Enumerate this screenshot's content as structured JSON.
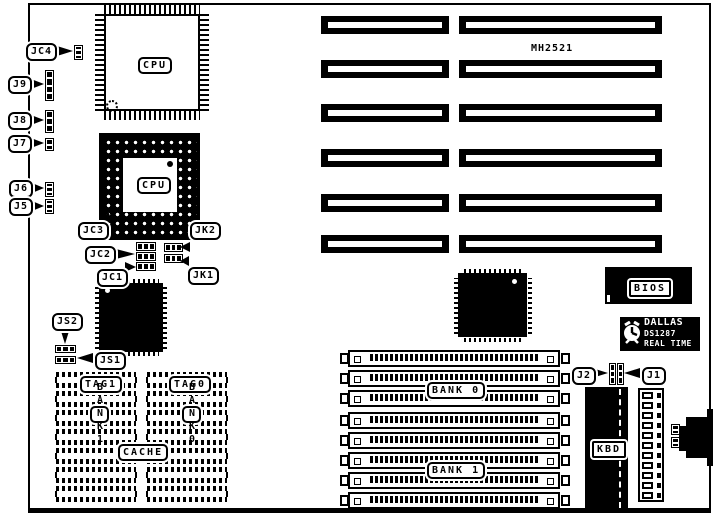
{
  "diagram": {
    "board_model": "MH2521",
    "chips": {
      "cpu_qfp": "CPU",
      "cpu_pga": "CPU",
      "bios": "BIOS",
      "kbd": "KBD",
      "rtc_line1": "DALLAS",
      "rtc_line2": "DS1287",
      "rtc_line3": "REAL TIME"
    },
    "jumpers": {
      "jc4": "JC4",
      "j9": "J9",
      "j8": "J8",
      "j7": "J7",
      "j6": "J6",
      "j5": "J5",
      "jc3": "JC3",
      "jk2": "JK2",
      "jc2": "JC2",
      "jk1": "JK1",
      "jc1": "JC1",
      "js2": "JS2",
      "js1": "JS1",
      "j2": "J2",
      "j1": "J1"
    },
    "memory": {
      "bank0_label": "BANK 0",
      "bank1_label": "BANK 1",
      "simm_socket_count": 8
    },
    "cache": {
      "tag1": "TAG1",
      "tag0": "TAG0",
      "label": "CACHE",
      "bank1_vertical": "BANK1",
      "bank0_vertical": "BANK0",
      "chips_per_bank": 7
    },
    "expansion": {
      "isa_slot_count": 6
    }
  }
}
